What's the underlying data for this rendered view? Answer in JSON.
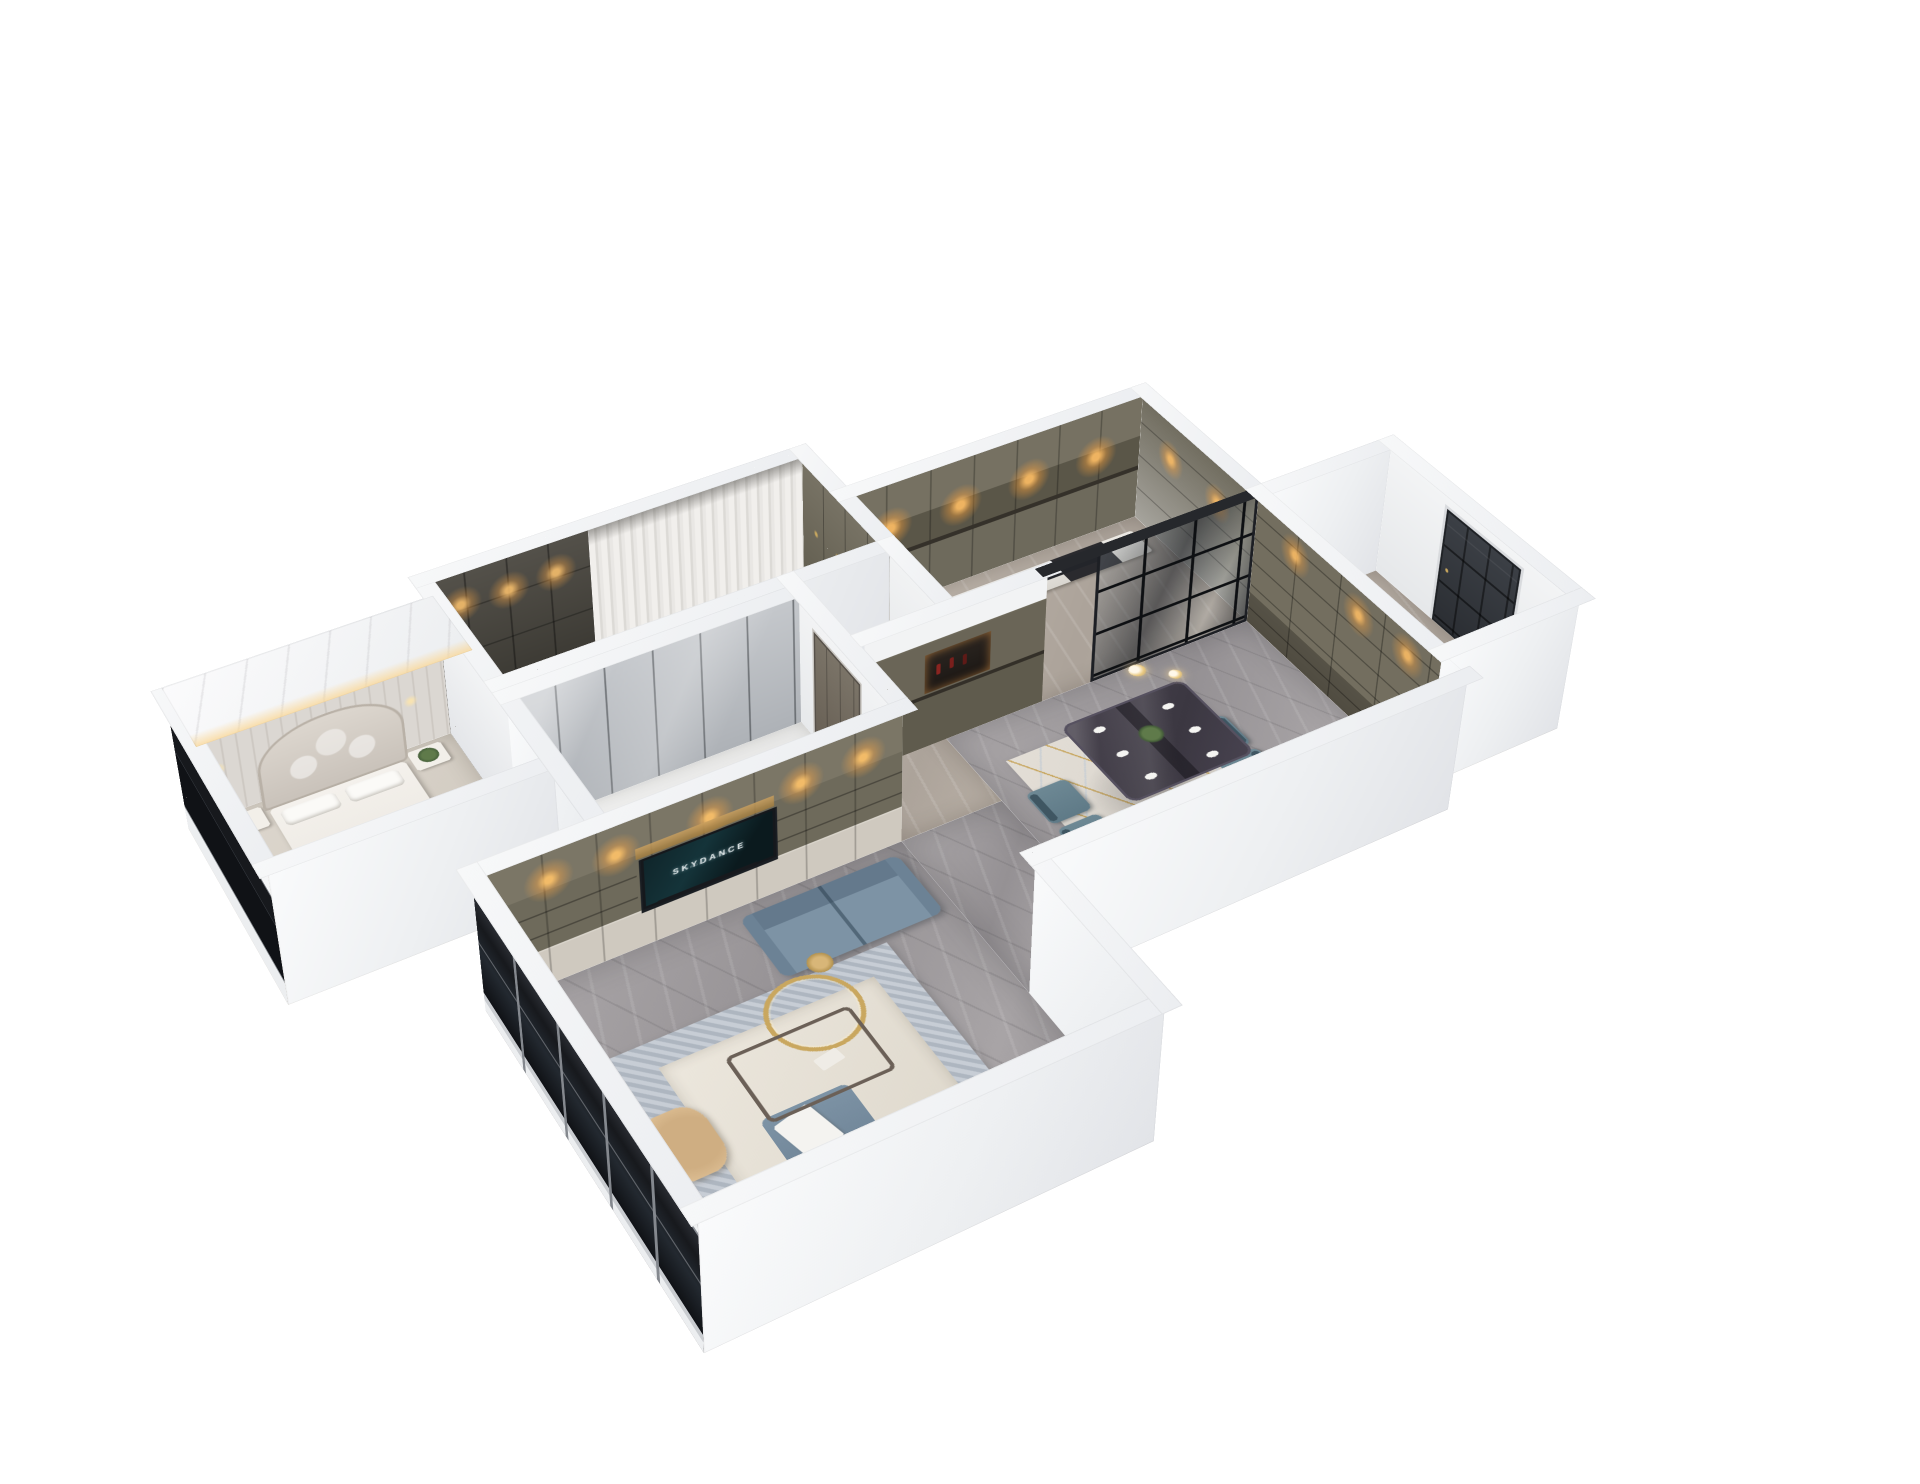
{
  "scene": {
    "background": "#ffffff",
    "tv": {
      "line1": "SKYDANCE",
      "line2": "PRODUCTIONS"
    },
    "palette": {
      "outer_wall": "#f3f4f6",
      "wall_shade": "#e2e4e8",
      "cabinet_olive": "#6e6a5c",
      "cabinet_dark": "#3b3933",
      "marble_floor_gray": "#a39fa1",
      "marble_floor_beige": "#b8afa5",
      "sofa_blue": "#7d93a5",
      "dining_chair_teal": "#6d8894",
      "rug_cream": "#e6e1d7",
      "rug_border_blue": "#aeb6c0",
      "accent_gold": "#c9a75f",
      "glass_dark": "#17191d",
      "warm_light": "#f0b763",
      "bedding_white": "#f4f1ec",
      "front_door_dark": "#34373d"
    },
    "rooms": [
      {
        "name": "master-bedroom",
        "objects": [
          "bed",
          "quilted-headboard",
          "nightstands",
          "plant",
          "foot-bench",
          "cove-lighting",
          "dark-window-band"
        ]
      },
      {
        "name": "walk-in-closet",
        "objects": [
          "dark-wardrobe-cabinets",
          "downlights",
          "hanging-clothes"
        ]
      },
      {
        "name": "dressing-room",
        "objects": [
          "sheer-curtains",
          "olive-wardrobe",
          "floor-grate"
        ]
      },
      {
        "name": "kitchen",
        "objects": [
          "upper-cabinets",
          "downlights",
          "counter-with-bottles",
          "black-glass-partition"
        ]
      },
      {
        "name": "second-bedroom",
        "objects": [
          "mirror-wardrobe",
          "rug"
        ]
      },
      {
        "name": "hallway",
        "objects": [
          "interior-door",
          "sideboard-with-wine-niche"
        ]
      },
      {
        "name": "living-room",
        "objects": [
          "tv-media-wall",
          "tv-screen",
          "l-shaped-blue-sofas",
          "coffee-table",
          "gold-ring-decor",
          "gold-stool",
          "tan-armchair",
          "patterned-rug",
          "floor-to-ceiling-window"
        ]
      },
      {
        "name": "dining-room",
        "objects": [
          "marble-dining-table",
          "six-teal-chairs",
          "white-plates",
          "centerpiece-plant",
          "geometric-rug",
          "glass-pendants"
        ]
      },
      {
        "name": "entry-foyer",
        "objects": [
          "bookshelf-wall",
          "dark-front-door"
        ]
      }
    ]
  }
}
